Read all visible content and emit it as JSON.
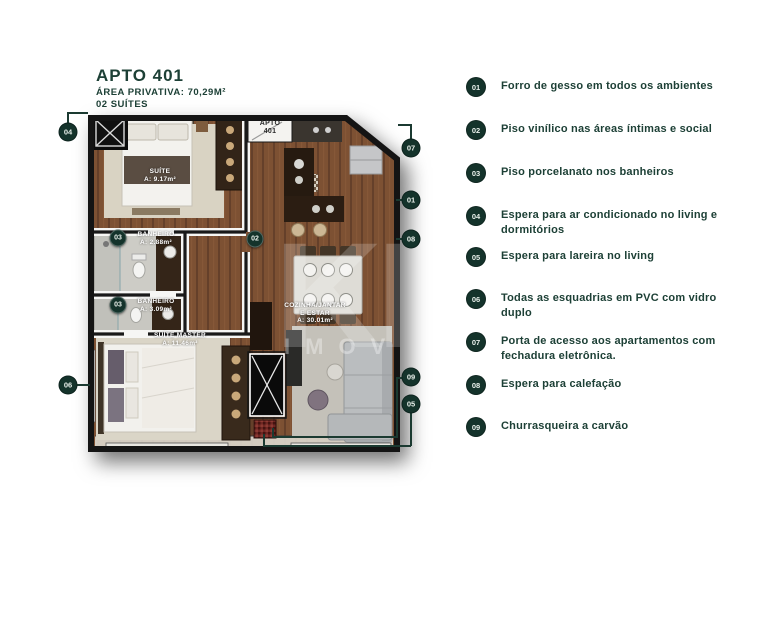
{
  "title_block": {
    "title": "APTO 401",
    "area_line": "ÁREA PRIVATIVA: 70,29M²",
    "suites_line": "02 SUÍTES"
  },
  "plan": {
    "door_label": {
      "line1": "APTO",
      "line2": "401"
    },
    "rooms": {
      "suite": {
        "name": "SUÍTE",
        "area": "A: 9.17m²"
      },
      "banheiro1": {
        "name": "BANHEIRO",
        "area": "A: 2.88m²"
      },
      "banheiro2": {
        "name": "BANHEIRO",
        "area": "A: 3.09m²"
      },
      "suite_master": {
        "name": "SUÍTE MASTER",
        "area": "A: 11.46m²"
      },
      "cozinha": {
        "name": "COZINHA/JANTAR",
        "name2": "E ESTAR",
        "area": "A: 30.01m²"
      }
    },
    "badges": {
      "b04": "04",
      "b07": "07",
      "b01": "01",
      "b08": "08",
      "b03a": "03",
      "b02": "02",
      "b03b": "03",
      "b06": "06",
      "b09": "09",
      "b05": "05"
    }
  },
  "watermark": {
    "big": "KP",
    "small": "IMOV"
  },
  "legend": {
    "items": [
      {
        "num": "01",
        "text": "Forro de gesso em todos os ambientes"
      },
      {
        "num": "02",
        "text": "Piso vinílico nas áreas íntimas e social"
      },
      {
        "num": "03",
        "text": "Piso porcelanato nos banheiros"
      },
      {
        "num": "04",
        "text": "Espera para ar condicionado no living e dormitórios"
      },
      {
        "num": "05",
        "text": "Espera para lareira no living"
      },
      {
        "num": "06",
        "text": "Todas as esquadrias em PVC com vidro duplo"
      },
      {
        "num": "07",
        "text": "Porta de acesso aos apartamentos com fechadura eletrônica."
      },
      {
        "num": "08",
        "text": "Espera para calefação"
      },
      {
        "num": "09",
        "text": "Churrasqueira a carvão"
      }
    ]
  },
  "colors": {
    "accent_green": "#1d4036",
    "badge_green": "#14332b",
    "wood": "#7d5133"
  }
}
